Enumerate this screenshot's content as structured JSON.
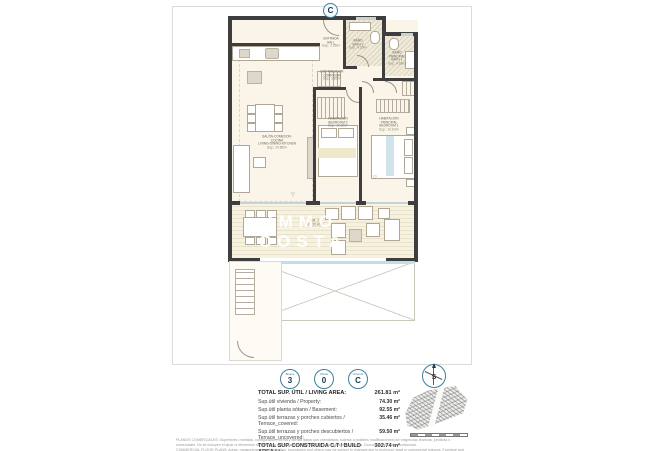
{
  "colors": {
    "accent": "#3f7f9d",
    "wall": "#3e3e3e",
    "room_fill": "#faf5e8",
    "pool_edge": "#bfdfe9"
  },
  "plan": {
    "unit_marker": "C",
    "watermark_line1": "IMMO",
    "watermark_line2": "COSTA",
    "rooms": {
      "hall": {
        "es": "ENTRADA",
        "en": "HALL",
        "area": "Sup.: 2.05m²"
      },
      "bath2": {
        "es": "BAÑO",
        "en": "BATH 2",
        "area": "Sup.: 4.20m²"
      },
      "bath1": {
        "es": "BAÑO PRINCIPAL",
        "en": "BATH 1",
        "area": "Sup.: 4.65m²"
      },
      "corridor": {
        "es": "DISTRIBUIDOR",
        "en": "CORRIDOR",
        "area": "Sup.: 3.85m²"
      },
      "bedroom2": {
        "es": "HABITACIÓN",
        "en": "BEDROOM 2",
        "area": "Sup.: 10.90m²"
      },
      "bedroom1": {
        "es": "HABITACIÓN PRINCIPAL",
        "en": "BEDROOM 1",
        "area": "Sup.: 14.10m²"
      },
      "living": {
        "es": "SALÓN-COMEDOR-COCINA",
        "en": "LIVING-DINING-KITCHEN",
        "area": "Sup.: 24.85m²"
      },
      "terrace": {
        "es": "TER. 1",
        "en": "TERRACE",
        "area": "SUP: 35.46m²"
      }
    }
  },
  "summary": {
    "badges": [
      {
        "label": "Bloque",
        "value": "3"
      },
      {
        "label": "Planta",
        "value": "0"
      },
      {
        "label": "Vivienda",
        "value": "C"
      }
    ],
    "compass_letter": "S",
    "rows": [
      {
        "label": "TOTAL SUP. ÚTIL / LIVING AREA:",
        "value": "261.81 m²"
      },
      {
        "label": "Sup.útil vivienda / Property:",
        "value": "74.30 m²"
      },
      {
        "label": "Sup.útil planta sótano / Basement:",
        "value": "92.55 m²"
      },
      {
        "label": "Sup.útil terrazas y porches cubiertos / Terrace_covered:",
        "value": "35.46 m²"
      },
      {
        "label": "Sup.útil terrazas y porches descubiertos / Terrace_uncovered:",
        "value": "59.50 m²"
      },
      {
        "label": "TOTAL SUP. CONSTRUIDA C.T / BUILD AREA I.I :",
        "value": "302.74 m²"
      }
    ]
  },
  "disclaimer": {
    "line1": "PLANOS COMERCIALES: Superficies, medidas, configuración, forma y demás datos son orientativos, sujetos a posibles modificaciones por exigencias técnicas, jurídicas o comerciales. No se incluyen el ajuar ni elementos de jardinería o decoración, salvo aquellos expresamente indicados. Documento sin valor contractual.",
    "line2": "COMMERCIAL FLOOR PLANS: Areas, measurements, configuration, boundaries and others may be subject to changes due to technical, legal or commercial reasons. Furniture and gardening elements are not included (except those expressly indicated). Document without contractual value."
  }
}
